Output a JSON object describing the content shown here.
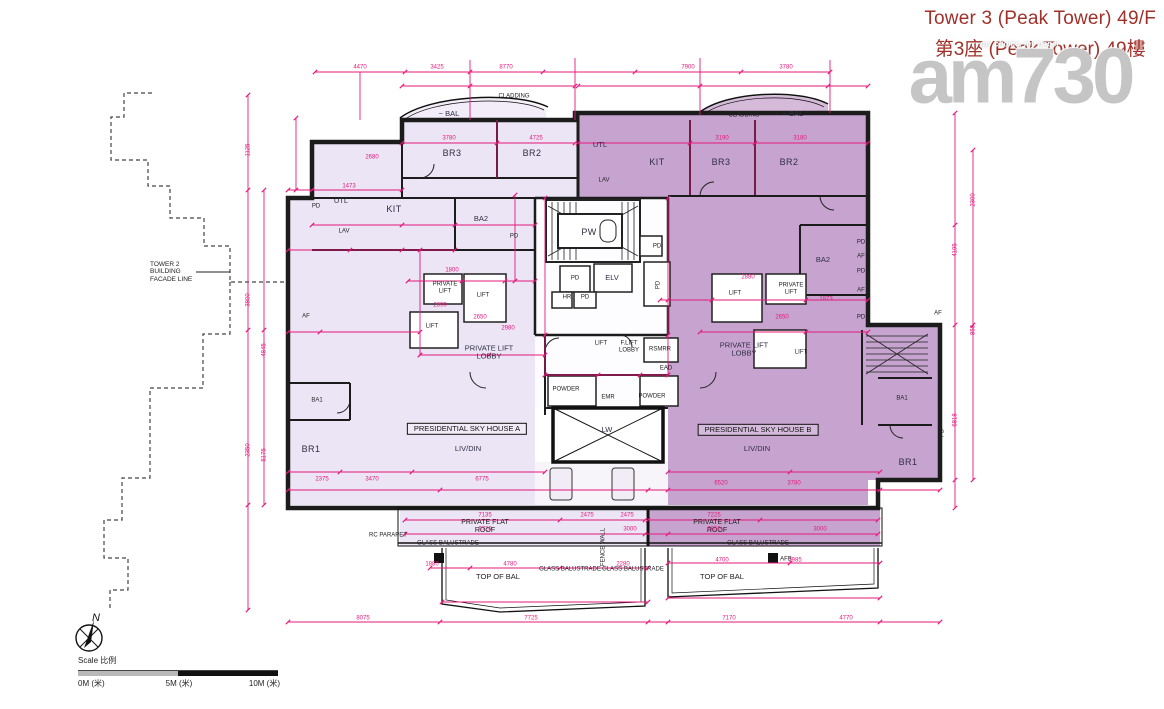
{
  "header": {
    "title_line1": "Tower 3 (Peak Tower) 49/F",
    "title_line2": "第3座 (Peak Tower) 49樓",
    "watermark": "am730",
    "watermark_tagline": "my choice, my paper",
    "title_color": "#a0312a"
  },
  "scale_bar": {
    "label": "Scale 比例",
    "ticks": [
      "0M (米)",
      "5M (米)",
      "10M (米)"
    ],
    "north_label": "N"
  },
  "plan": {
    "unit_a_name": "PRESIDENTIAL SKY HOUSE A",
    "unit_b_name": "PRESIDENTIAL SKY HOUSE B",
    "colors": {
      "unit_a_fill": "#ece5f5",
      "unit_b_fill": "#c7a4cf",
      "dimension_pink": "#e5187a",
      "wall_black": "#1c1c1c"
    },
    "labels": [
      {
        "t": "~ BAL",
        "x": 449,
        "y": 114,
        "c": "tiny"
      },
      {
        "t": "CLADDING",
        "x": 514,
        "y": 97,
        "c": "micro"
      },
      {
        "t": "BR3",
        "x": 452,
        "y": 153,
        "c": "room"
      },
      {
        "t": "BR2",
        "x": 532,
        "y": 153,
        "c": "room"
      },
      {
        "t": "PD",
        "x": 316,
        "y": 207,
        "c": "micro"
      },
      {
        "t": "UTL",
        "x": 341,
        "y": 201,
        "c": "tiny"
      },
      {
        "t": "KIT",
        "x": 394,
        "y": 209,
        "c": "room"
      },
      {
        "t": "LAV",
        "x": 344,
        "y": 232,
        "c": "micro"
      },
      {
        "t": "BA2",
        "x": 481,
        "y": 219,
        "c": "tiny"
      },
      {
        "t": "PD",
        "x": 514,
        "y": 237,
        "c": "micro"
      },
      {
        "t": "PRIVATE LIFT",
        "x": 445,
        "y": 288,
        "c": "micro",
        "w": 32
      },
      {
        "t": "LIFT",
        "x": 483,
        "y": 296,
        "c": "micro"
      },
      {
        "t": "LIFT",
        "x": 432,
        "y": 327,
        "c": "micro"
      },
      {
        "t": "PRIVATE LIFT LOBBY",
        "x": 489,
        "y": 353,
        "c": "tiny",
        "w": 52
      },
      {
        "t": "POWDER",
        "x": 566,
        "y": 390,
        "c": "micro"
      },
      {
        "t": "BA1",
        "x": 317,
        "y": 401,
        "c": "micro"
      },
      {
        "t": "BR1",
        "x": 311,
        "y": 449,
        "c": "room"
      },
      {
        "t": "PRESIDENTIAL SKY HOUSE A",
        "x": 467,
        "y": 429,
        "c": "unitbox"
      },
      {
        "t": "LIV/DIN",
        "x": 468,
        "y": 449,
        "c": "tiny"
      },
      {
        "t": "AF",
        "x": 306,
        "y": 317,
        "c": "micro"
      },
      {
        "t": "PW",
        "x": 589,
        "y": 232,
        "c": "room"
      },
      {
        "t": "PD",
        "x": 575,
        "y": 279,
        "c": "micro"
      },
      {
        "t": "ELV",
        "x": 612,
        "y": 278,
        "c": "tiny"
      },
      {
        "t": "HR",
        "x": 567,
        "y": 298,
        "c": "micro"
      },
      {
        "t": "PD",
        "x": 585,
        "y": 298,
        "c": "micro"
      },
      {
        "t": "PD",
        "x": 657,
        "y": 247,
        "c": "micro"
      },
      {
        "t": "PD",
        "x": 659,
        "y": 285,
        "c": "microv"
      },
      {
        "t": "LIFT",
        "x": 601,
        "y": 344,
        "c": "micro"
      },
      {
        "t": "F.LIFT LOBBY",
        "x": 629,
        "y": 347,
        "c": "micro",
        "w": 32
      },
      {
        "t": "RSMRR",
        "x": 660,
        "y": 350,
        "c": "micro"
      },
      {
        "t": "EAD",
        "x": 666,
        "y": 369,
        "c": "micro"
      },
      {
        "t": "EMR",
        "x": 608,
        "y": 398,
        "c": "micro"
      },
      {
        "t": "POWDER",
        "x": 652,
        "y": 397,
        "c": "micro"
      },
      {
        "t": "LW",
        "x": 607,
        "y": 430,
        "c": "tiny"
      },
      {
        "t": "UTL",
        "x": 600,
        "y": 145,
        "c": "tiny"
      },
      {
        "t": "KIT",
        "x": 657,
        "y": 162,
        "c": "room"
      },
      {
        "t": "LAV",
        "x": 604,
        "y": 181,
        "c": "micro"
      },
      {
        "t": "BR3",
        "x": 721,
        "y": 162,
        "c": "room"
      },
      {
        "t": "BR2",
        "x": 789,
        "y": 162,
        "c": "room"
      },
      {
        "t": "CLADDING",
        "x": 744,
        "y": 116,
        "c": "micro"
      },
      {
        "t": "~ BAL",
        "x": 793,
        "y": 114,
        "c": "tiny"
      },
      {
        "t": "BA2",
        "x": 823,
        "y": 260,
        "c": "tiny"
      },
      {
        "t": "PD",
        "x": 861,
        "y": 243,
        "c": "micro"
      },
      {
        "t": "AF",
        "x": 861,
        "y": 257,
        "c": "micro"
      },
      {
        "t": "PD",
        "x": 861,
        "y": 272,
        "c": "micro"
      },
      {
        "t": "AF",
        "x": 861,
        "y": 291,
        "c": "micro"
      },
      {
        "t": "PD",
        "x": 861,
        "y": 318,
        "c": "micro"
      },
      {
        "t": "AF",
        "x": 938,
        "y": 314,
        "c": "micro"
      },
      {
        "t": "LIFT",
        "x": 735,
        "y": 294,
        "c": "micro"
      },
      {
        "t": "PRIVATE LIFT",
        "x": 791,
        "y": 289,
        "c": "micro",
        "w": 32
      },
      {
        "t": "PRIVATE LIFT LOBBY",
        "x": 744,
        "y": 350,
        "c": "tiny",
        "w": 52
      },
      {
        "t": "LIFT",
        "x": 801,
        "y": 353,
        "c": "micro"
      },
      {
        "t": "PRESIDENTIAL SKY HOUSE B",
        "x": 758,
        "y": 430,
        "c": "unitbox"
      },
      {
        "t": "LIV/DIN",
        "x": 757,
        "y": 449,
        "c": "tiny"
      },
      {
        "t": "BA1",
        "x": 902,
        "y": 399,
        "c": "micro"
      },
      {
        "t": "BR1",
        "x": 908,
        "y": 462,
        "c": "room"
      },
      {
        "t": "PD",
        "x": 943,
        "y": 433,
        "c": "microv"
      },
      {
        "t": "PRIVATE FLAT ROOF",
        "x": 485,
        "y": 527,
        "c": "annotw",
        "w": 60
      },
      {
        "t": "RC PARAPET",
        "x": 388,
        "y": 536,
        "c": "micro"
      },
      {
        "t": "GLASS BALUSTRADE",
        "x": 448,
        "y": 544,
        "c": "micro"
      },
      {
        "t": "FENCE WALL",
        "x": 604,
        "y": 547,
        "c": "microv"
      },
      {
        "t": "GLASS BALUSTRADE",
        "x": 570,
        "y": 570,
        "c": "micro"
      },
      {
        "t": "GLASS BALUSTRADE",
        "x": 633,
        "y": 570,
        "c": "micro"
      },
      {
        "t": "TOP OF BAL",
        "x": 498,
        "y": 577,
        "c": "annot"
      },
      {
        "t": "PRIVATE FLAT ROOF",
        "x": 717,
        "y": 527,
        "c": "annotw",
        "w": 60
      },
      {
        "t": "GLASS BALUSTRADE",
        "x": 758,
        "y": 544,
        "c": "micro"
      },
      {
        "t": "AFB",
        "x": 786,
        "y": 560,
        "c": "micro"
      },
      {
        "t": "TOP OF BAL",
        "x": 722,
        "y": 577,
        "c": "annot"
      },
      {
        "t": "TOWER 2 BUILDING FACADE LINE",
        "x": 150,
        "y": 272,
        "c": "annot-left",
        "w": 50
      },
      {
        "t": "4470",
        "x": 360,
        "y": 68,
        "c": "dim"
      },
      {
        "t": "3425",
        "x": 437,
        "y": 68,
        "c": "dim"
      },
      {
        "t": "8770",
        "x": 506,
        "y": 68,
        "c": "dim"
      },
      {
        "t": "7900",
        "x": 688,
        "y": 68,
        "c": "dim"
      },
      {
        "t": "3780",
        "x": 786,
        "y": 68,
        "c": "dim"
      },
      {
        "t": "3780",
        "x": 449,
        "y": 139,
        "c": "dim"
      },
      {
        "t": "4725",
        "x": 536,
        "y": 139,
        "c": "dim"
      },
      {
        "t": "3190",
        "x": 722,
        "y": 139,
        "c": "dim"
      },
      {
        "t": "3180",
        "x": 800,
        "y": 139,
        "c": "dim"
      },
      {
        "t": "1473",
        "x": 349,
        "y": 187,
        "c": "dim"
      },
      {
        "t": "2680",
        "x": 372,
        "y": 158,
        "c": "dim"
      },
      {
        "t": "1800",
        "x": 452,
        "y": 271,
        "c": "dim"
      },
      {
        "t": "2690",
        "x": 440,
        "y": 306,
        "c": "dim"
      },
      {
        "t": "2650",
        "x": 480,
        "y": 318,
        "c": "dim"
      },
      {
        "t": "2980",
        "x": 508,
        "y": 329,
        "c": "dim"
      },
      {
        "t": "2880",
        "x": 748,
        "y": 278,
        "c": "dim"
      },
      {
        "t": "2650",
        "x": 782,
        "y": 318,
        "c": "dim"
      },
      {
        "t": "1873",
        "x": 826,
        "y": 300,
        "c": "dim"
      },
      {
        "t": "2375",
        "x": 322,
        "y": 480,
        "c": "dim"
      },
      {
        "t": "3470",
        "x": 372,
        "y": 480,
        "c": "dim"
      },
      {
        "t": "6775",
        "x": 482,
        "y": 480,
        "c": "dim"
      },
      {
        "t": "6520",
        "x": 721,
        "y": 484,
        "c": "dim"
      },
      {
        "t": "3780",
        "x": 794,
        "y": 484,
        "c": "dim"
      },
      {
        "t": "7135",
        "x": 485,
        "y": 516,
        "c": "dim"
      },
      {
        "t": "2475",
        "x": 587,
        "y": 516,
        "c": "dim"
      },
      {
        "t": "2475",
        "x": 627,
        "y": 516,
        "c": "dim"
      },
      {
        "t": "6720",
        "x": 485,
        "y": 530,
        "c": "dim"
      },
      {
        "t": "3000",
        "x": 630,
        "y": 530,
        "c": "dim"
      },
      {
        "t": "7225",
        "x": 714,
        "y": 516,
        "c": "dim"
      },
      {
        "t": "6850",
        "x": 714,
        "y": 530,
        "c": "dim"
      },
      {
        "t": "3000",
        "x": 820,
        "y": 530,
        "c": "dim"
      },
      {
        "t": "1880",
        "x": 432,
        "y": 565,
        "c": "dim"
      },
      {
        "t": "4780",
        "x": 510,
        "y": 565,
        "c": "dim"
      },
      {
        "t": "2280",
        "x": 623,
        "y": 565,
        "c": "dim"
      },
      {
        "t": "4700",
        "x": 722,
        "y": 561,
        "c": "dim"
      },
      {
        "t": "1985",
        "x": 795,
        "y": 561,
        "c": "dim"
      },
      {
        "t": "8075",
        "x": 363,
        "y": 619,
        "c": "dim"
      },
      {
        "t": "7725",
        "x": 531,
        "y": 619,
        "c": "dim"
      },
      {
        "t": "7170",
        "x": 729,
        "y": 619,
        "c": "dim"
      },
      {
        "t": "4770",
        "x": 846,
        "y": 619,
        "c": "dim"
      },
      {
        "t": "1125",
        "x": 249,
        "y": 150,
        "c": "dimv"
      },
      {
        "t": "3800",
        "x": 249,
        "y": 300,
        "c": "dimv"
      },
      {
        "t": "2350",
        "x": 249,
        "y": 450,
        "c": "dimv"
      },
      {
        "t": "4845",
        "x": 265,
        "y": 350,
        "c": "dimv"
      },
      {
        "t": "5175",
        "x": 265,
        "y": 455,
        "c": "dimv"
      },
      {
        "t": "4195",
        "x": 956,
        "y": 250,
        "c": "dimv"
      },
      {
        "t": "6818",
        "x": 956,
        "y": 420,
        "c": "dimv"
      },
      {
        "t": "2300",
        "x": 974,
        "y": 200,
        "c": "dimv"
      },
      {
        "t": "858",
        "x": 974,
        "y": 330,
        "c": "dimv"
      }
    ]
  }
}
